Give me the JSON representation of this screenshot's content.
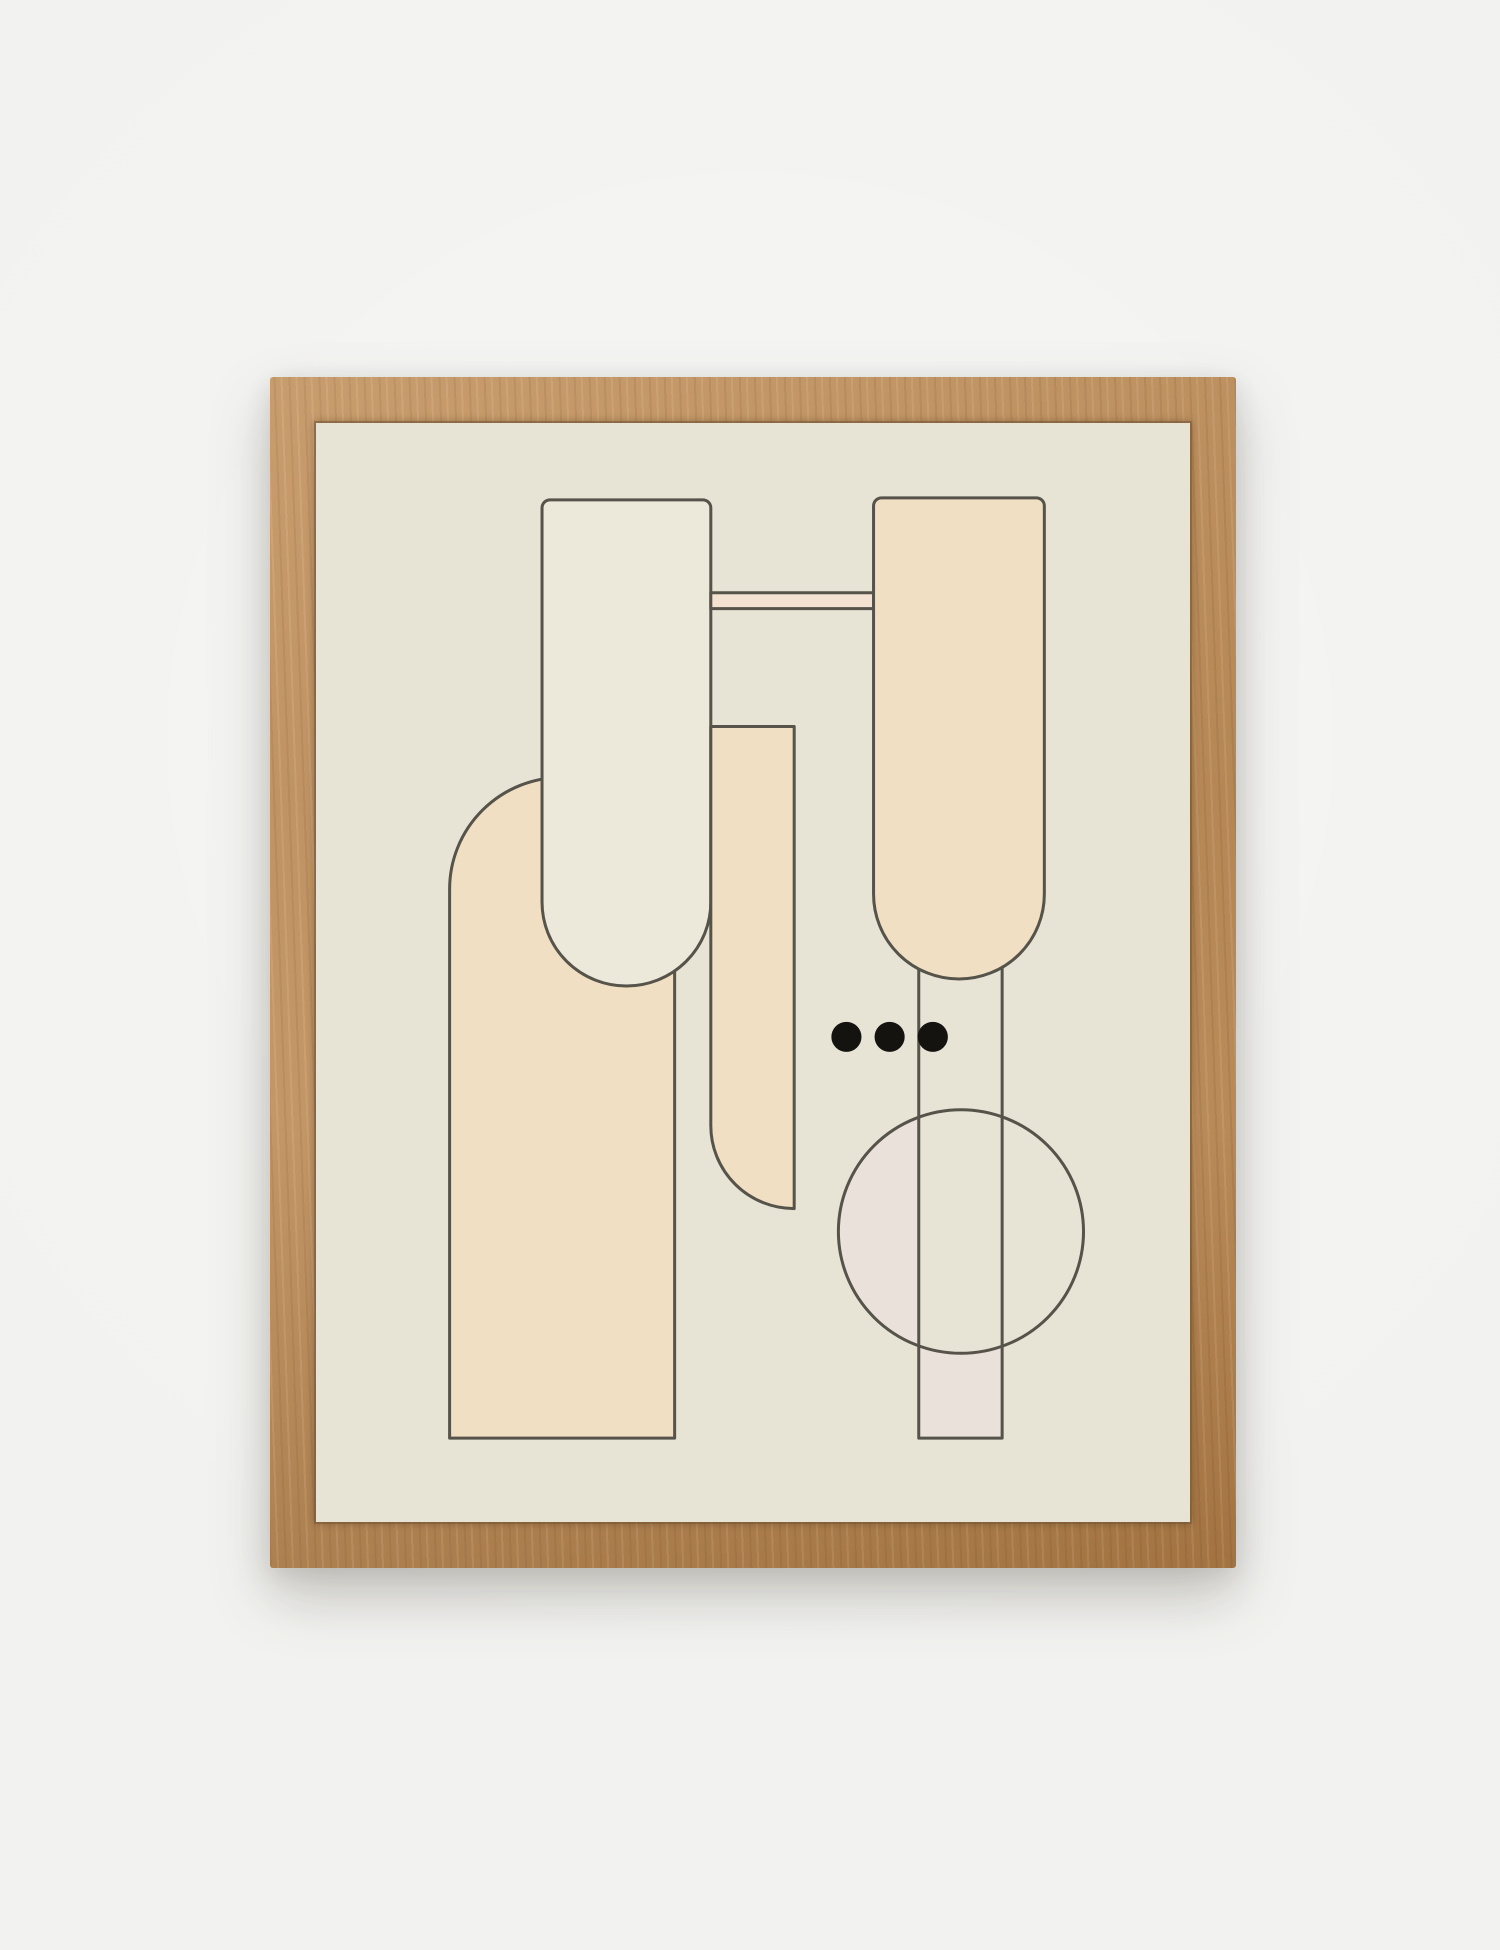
{
  "meta": {
    "description": "Photograph of a framed abstract geometric art print hanging on a light wall"
  },
  "colors": {
    "wall": "#f2f2f0",
    "wood": "#bb8a55",
    "art_bg": "#e7e4d6",
    "cream_light": "#ece9db",
    "peach": "#f0dfc3",
    "bar_peach": "#f3e2d1",
    "blush": "#eae1db",
    "ink": "#151310",
    "stroke": "#56534a"
  },
  "art": {
    "stroke_width": "3",
    "paths": {
      "arch": "M133 1017 L133 467 A112 112 0 0 1 357 467 L357 1017 Z",
      "pill_left": "M233 77 L385 77 A8 8 0 0 1 393 85 L393 480 A84 84 0 0 1 225 480 L225 85 A8 8 0 0 1 233 77 Z",
      "column_mid": "M393 304 L476 304 L476 787 A83 83 0 0 1 393 704 L393 304 Z",
      "connector_bar": "M393 170 L555 170 L555 186 L393 186 Z",
      "pill_right": "M563 75 L717 75 A8 8 0 0 1 725 83 L725 472 A85 85 0 0 1 555 472 L555 83 A8 8 0 0 1 563 75 Z",
      "blush_rect_bottom": "M600 900 L683 900 L683 1017 L600 1017 Z",
      "disc": "M520 810 a122 122 0 1 0 244 0 a122 122 0 1 0 -244 0",
      "blush_segment": "M600 695 A122 122 0 0 0 600 925 Z",
      "rect_outline": "M600 547 L600 1017 L683 1017 L683 545",
      "circle_outline": "M520 810 a122 122 0 1 0 244 0 a122 122 0 1 0 -244 0",
      "dots": "M513 615 a15 15 0 1 0 30 0 a15 15 0 1 0 -30 0 M556 615 a15 15 0 1 0 30 0 a15 15 0 1 0 -30 0 M599 615 a15 15 0 1 0 30 0 a15 15 0 1 0 -30 0"
    }
  }
}
